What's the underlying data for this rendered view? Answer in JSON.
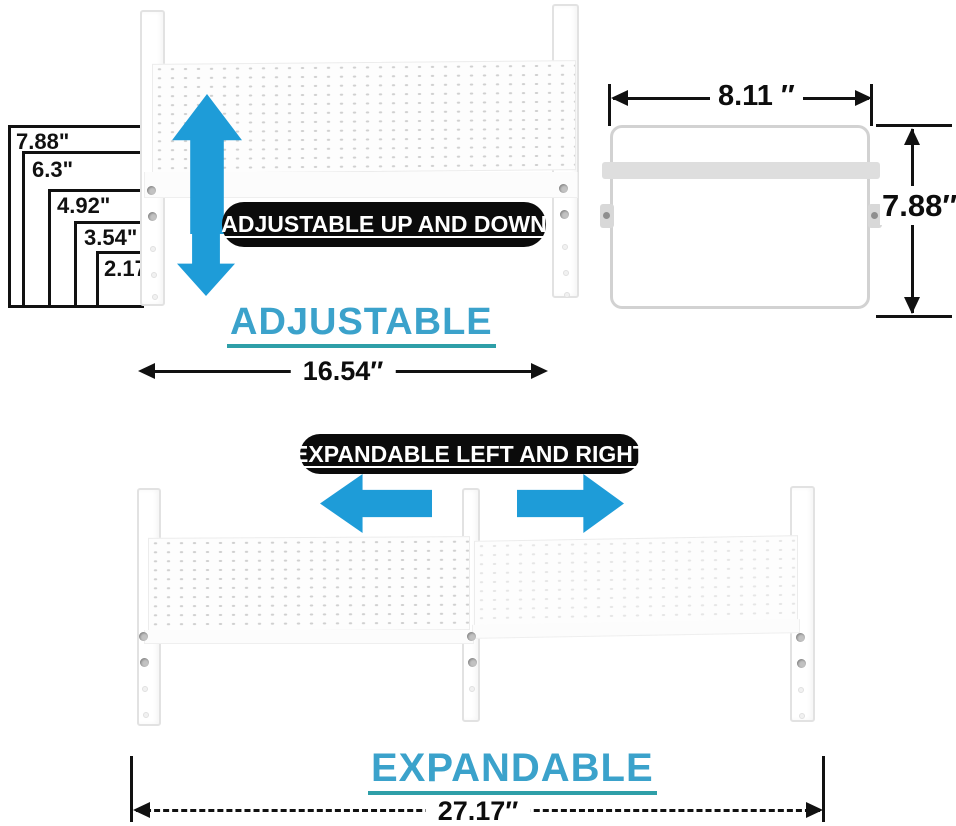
{
  "colors": {
    "arrow-blue": "#1E9CD8",
    "heading-blue": "#3BA2CB",
    "underline-teal": "#2E9FA8",
    "pill-bg": "#0b0b0b",
    "pill-text": "#ffffff",
    "line-black": "#111111"
  },
  "adjustable": {
    "heights": [
      "7.88\"",
      "6.3\"",
      "4.92\"",
      "3.54\"",
      "2.17\""
    ],
    "callout": "ADJUSTABLE UP AND DOWN",
    "heading": "ADJUSTABLE",
    "width": "16.54″"
  },
  "side_view": {
    "width": "8.11 ″",
    "height": "7.88″"
  },
  "expandable": {
    "callout": "EXPANDABLE LEFT AND RIGHT",
    "heading": "EXPANDABLE",
    "width": "27.17″"
  }
}
